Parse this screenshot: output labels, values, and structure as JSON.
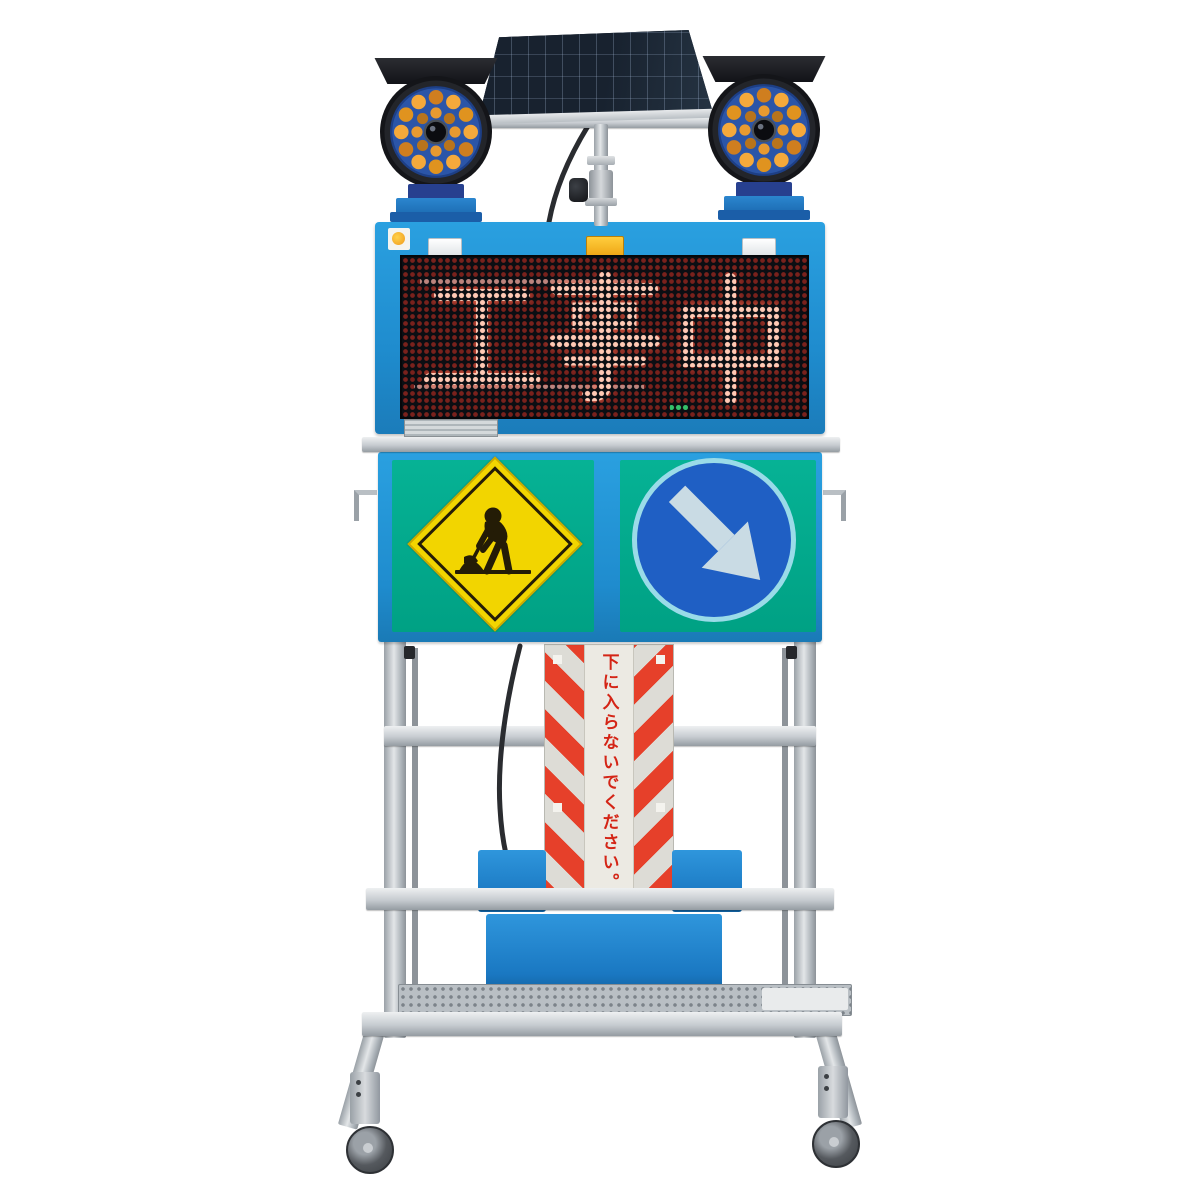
{
  "led_display": {
    "message": "工事中",
    "on_color": "#ffc9b4",
    "off_color": "#7f221c",
    "bg_color": "#0b0e13"
  },
  "pole_sign": {
    "text": "下に入らないでください。",
    "text_color": "#d42516",
    "stripe_red": "#e6402a",
    "stripe_silver": "#dddcd6"
  },
  "panel_signs": {
    "panel_bg": "#00a98c",
    "work_sign_diamond_color": "#f2d500",
    "work_sign_figure_color": "#241c06",
    "arrow_sign_circle_color": "#1f5fc4",
    "arrow_sign_arrow_color": "#c9dbe4",
    "arrow_sign_rim_color": "#9adbe8"
  },
  "structure": {
    "frame_blue": "#2191d4",
    "metal_gray": "#c0c6cb",
    "battery_box_blue": "#1e7fd0",
    "solar_panel_color": "#141d2a",
    "beacon_led_amber": "#f2a83b",
    "beacon_board_blue": "#2b55a8",
    "caster_count_visible": "2"
  }
}
